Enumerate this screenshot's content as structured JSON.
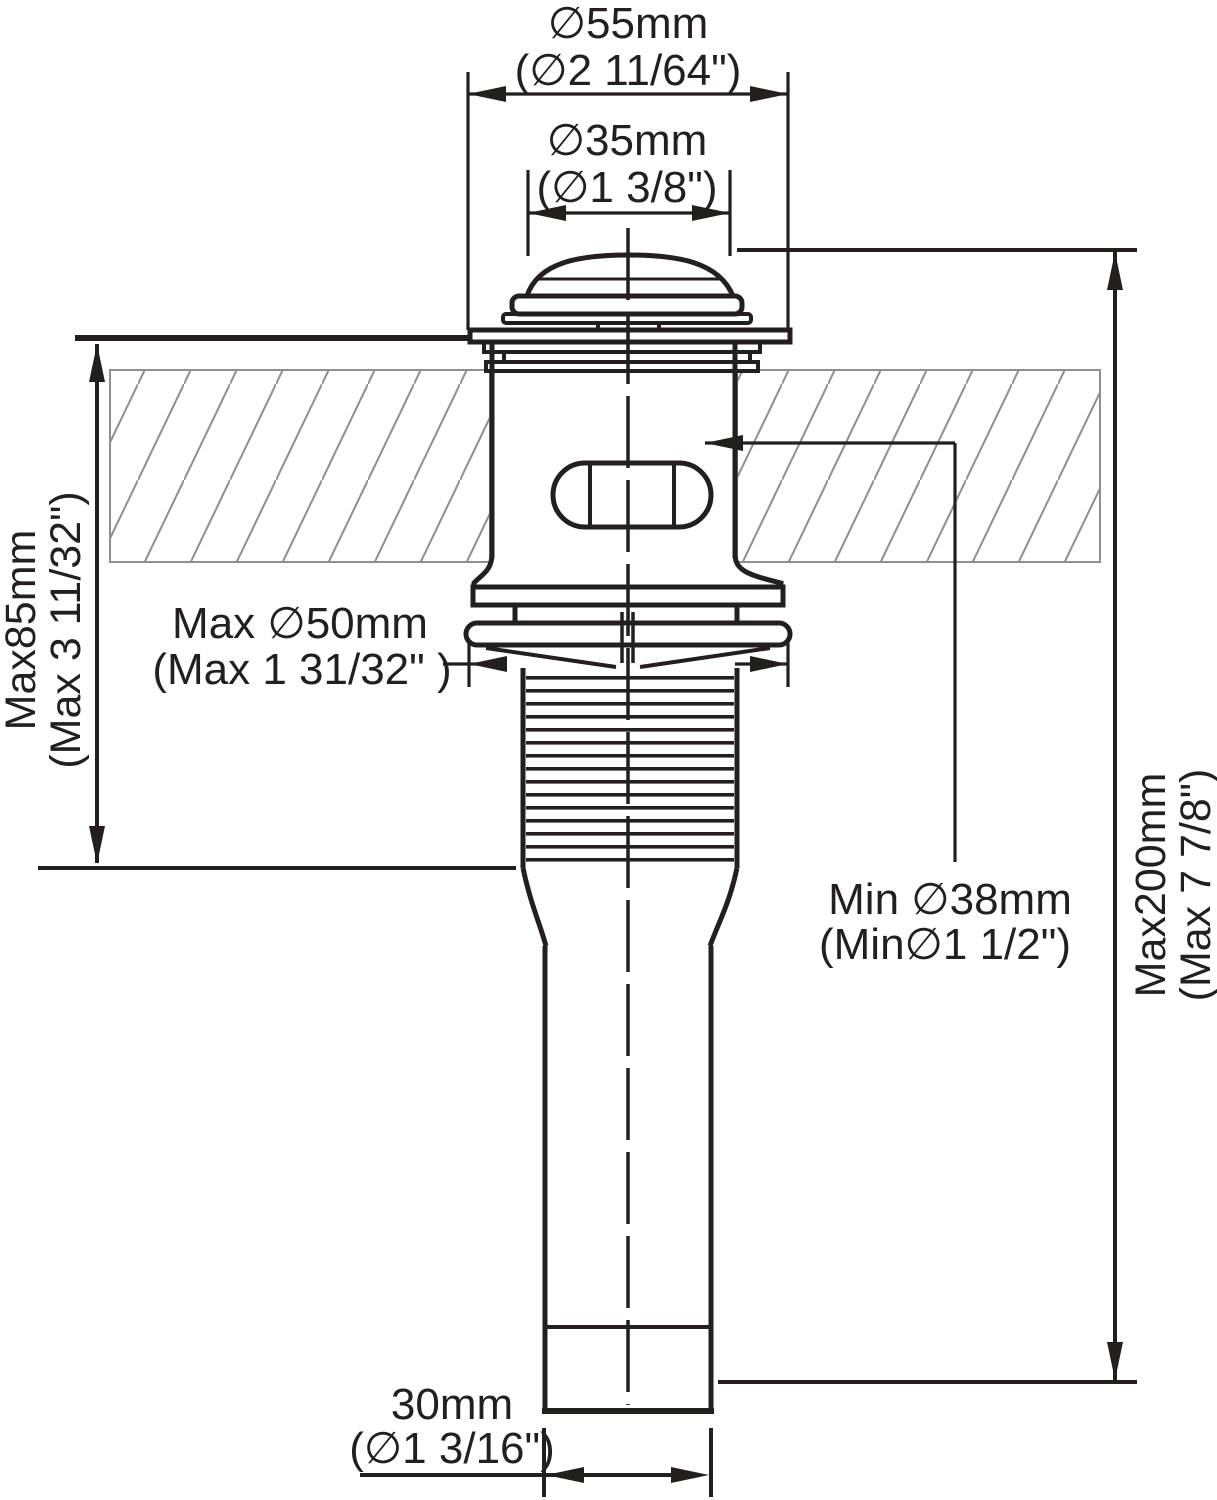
{
  "diagram": {
    "type": "technical-dimension-drawing",
    "subject": "bathroom sink pop-up drain assembly",
    "colors": {
      "line": "#231f1f",
      "hatch": "#8f8f8f",
      "background": "#ffffff"
    },
    "labels": {
      "flange_outer_diameter": {
        "metric": "∅55mm",
        "imperial": "(∅2 11/64\")"
      },
      "cap_top_diameter": {
        "metric": "∅35mm",
        "imperial": "(∅1 3/8\")"
      },
      "max_deck_thickness": {
        "metric": "Max85mm",
        "imperial": "(Max 3 11/32\")"
      },
      "max_nut_diameter": {
        "metric": "Max ∅50mm",
        "imperial": "(Max 1 31/32\" )"
      },
      "min_hole_diameter": {
        "metric": "Min ∅38mm",
        "imperial": "(Min∅1 1/2\")"
      },
      "max_overall_length": {
        "metric": "Max200mm",
        "imperial": "(Max 7 7/8\")"
      },
      "tailpipe_diameter": {
        "metric": "30mm",
        "imperial": "(∅1 3/16\")"
      }
    }
  }
}
